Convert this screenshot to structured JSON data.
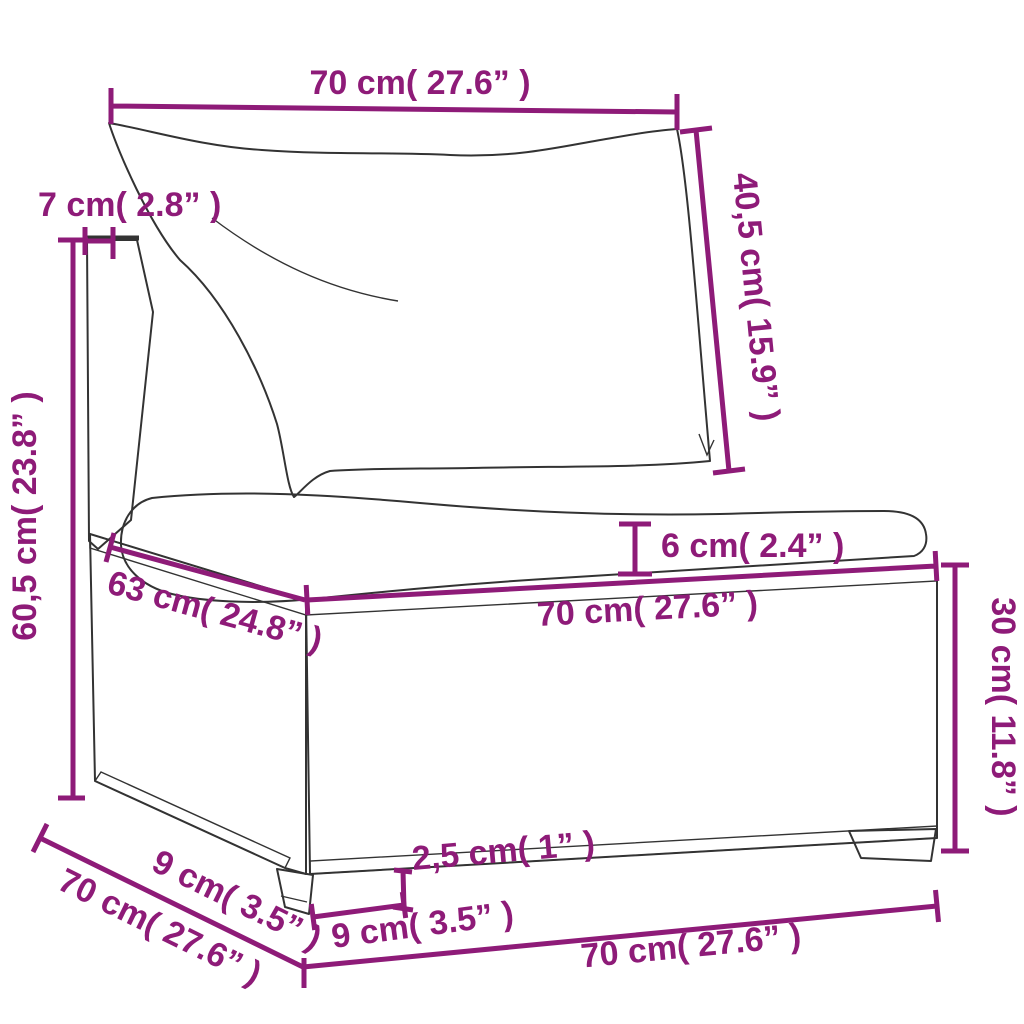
{
  "diagram": {
    "accent_color": "#8E1B78",
    "outline_color": "#333333",
    "dimensions": {
      "back_width": "70 cm( 27.6” )",
      "back_thickness": "7 cm( 2.8” )",
      "back_cushion_height": "40,5 cm( 15.9” )",
      "total_height": "60,5 cm( 23.8” )",
      "seat_cushion_thickness": "6 cm( 2.4” )",
      "seat_width": "70 cm( 27.6” )",
      "seat_depth": "63 cm( 24.8” )",
      "base_height": "30 cm( 11.8” )",
      "foot_inset": "9 cm( 3.5” )",
      "total_depth": "70 cm( 27.6” )",
      "foot_height": "2,5 cm( 1” )",
      "foot_width": "9 cm( 3.5” )",
      "base_width": "70 cm( 27.6” )"
    }
  }
}
